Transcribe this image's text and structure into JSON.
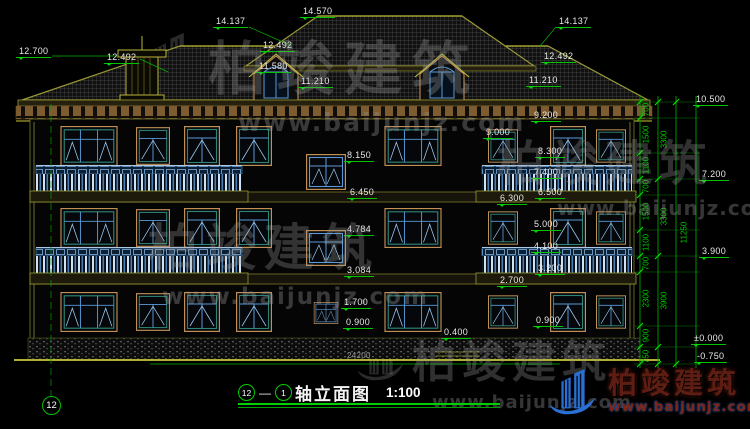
{
  "title": {
    "bubble_left": "12",
    "separator": "—",
    "bubble_right": "1",
    "text": "轴立面图",
    "scale": "1:100"
  },
  "axis": {
    "left_bubble": "12"
  },
  "watermark": {
    "brand": "柏竣建筑",
    "url": "www.baijunjz.com"
  },
  "logo": {
    "brand": "柏竣建筑",
    "url": "www.baijunjz.com"
  },
  "elevation_labels": [
    {
      "t": "14.137",
      "x": 213,
      "y": 16
    },
    {
      "t": "14.570",
      "x": 300,
      "y": 6
    },
    {
      "t": "14.137",
      "x": 556,
      "y": 16
    },
    {
      "t": "12.700",
      "x": 16,
      "y": 46
    },
    {
      "t": "12.492",
      "x": 104,
      "y": 52
    },
    {
      "t": "12.492",
      "x": 260,
      "y": 40
    },
    {
      "t": "11.580",
      "x": 256,
      "y": 61
    },
    {
      "t": "11.210",
      "x": 298,
      "y": 76
    },
    {
      "t": "12.492",
      "x": 541,
      "y": 51
    },
    {
      "t": "11.210",
      "x": 526,
      "y": 75
    },
    {
      "t": "8.150",
      "x": 344,
      "y": 150
    },
    {
      "t": "6.450",
      "x": 347,
      "y": 187
    },
    {
      "t": "4.784",
      "x": 344,
      "y": 224
    },
    {
      "t": "3.084",
      "x": 344,
      "y": 265
    },
    {
      "t": "1.700",
      "x": 341,
      "y": 297
    },
    {
      "t": "0.900",
      "x": 343,
      "y": 317
    },
    {
      "t": "9.000",
      "x": 483,
      "y": 127
    },
    {
      "t": "9.200",
      "x": 531,
      "y": 110
    },
    {
      "t": "8.300",
      "x": 535,
      "y": 146
    },
    {
      "t": "7.400",
      "x": 531,
      "y": 167
    },
    {
      "t": "6.500",
      "x": 535,
      "y": 187
    },
    {
      "t": "6.300",
      "x": 497,
      "y": 193
    },
    {
      "t": "5.000",
      "x": 531,
      "y": 219
    },
    {
      "t": "4.100",
      "x": 531,
      "y": 241
    },
    {
      "t": "3.200",
      "x": 535,
      "y": 263
    },
    {
      "t": "2.700",
      "x": 497,
      "y": 275
    },
    {
      "t": "0.900",
      "x": 533,
      "y": 315
    },
    {
      "t": "0.400",
      "x": 441,
      "y": 327
    },
    {
      "t": "10.500",
      "x": 693,
      "y": 94
    },
    {
      "t": "7.200",
      "x": 699,
      "y": 169
    },
    {
      "t": "3.900",
      "x": 699,
      "y": 246
    },
    {
      "t": "±0.000",
      "x": 691,
      "y": 333
    },
    {
      "t": "-0.750",
      "x": 694,
      "y": 351
    },
    {
      "t": "24200",
      "x": 344,
      "y": 351,
      "c": "gray"
    }
  ],
  "chain_dims": [
    {
      "t": "700",
      "x": 646,
      "y": 110
    },
    {
      "t": "1500",
      "x": 646,
      "y": 135
    },
    {
      "t": "1100",
      "x": 646,
      "y": 166
    },
    {
      "t": "700",
      "x": 646,
      "y": 187
    },
    {
      "t": "1500",
      "x": 646,
      "y": 212
    },
    {
      "t": "1100",
      "x": 646,
      "y": 243
    },
    {
      "t": "700",
      "x": 646,
      "y": 264
    },
    {
      "t": "2300",
      "x": 646,
      "y": 299
    },
    {
      "t": "900",
      "x": 646,
      "y": 336
    },
    {
      "t": "750",
      "x": 646,
      "y": 357
    },
    {
      "t": "3300",
      "x": 664,
      "y": 140
    },
    {
      "t": "3300",
      "x": 664,
      "y": 217
    },
    {
      "t": "3900",
      "x": 664,
      "y": 301
    },
    {
      "t": "11250",
      "x": 684,
      "y": 233
    }
  ]
}
